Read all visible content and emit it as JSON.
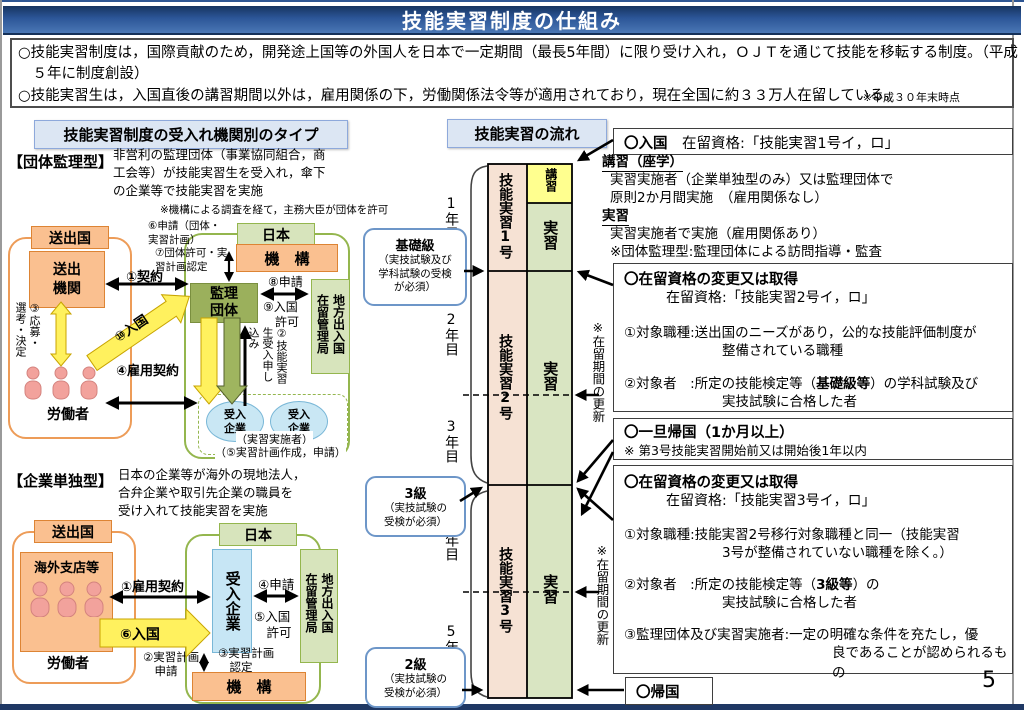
{
  "page": {
    "title": "技能実習制度の仕組み",
    "number": "5"
  },
  "overview": {
    "b1": "○技能実習制度は，国際貢献のため，開発途上国等の外国人を日本で一定期間（最長5年間）に限り受け入れ，ＯＪＴを通じて技能を移転する制度。（平成５年に制度創設）",
    "b2": "○技能実習生は，入国直後の講習期間以外は，雇用関係の下，労働関係法令等が適用されており，現在全国に約３３万人在留している。",
    "note": "※平成３０年末時点"
  },
  "left": {
    "header": "技能実習制度の受入れ機関別のタイプ",
    "dantai": {
      "label": "【団体監理型】",
      "desc": "非営利の監理団体（事業協同組合，商\n工会等）が技能実習生を受入れ，傘下\nの企業等で技能実習を実施",
      "note": "※機構による調査を経て，主務大臣が団体を許可",
      "sending_country": "送出国",
      "sending_org": "送出\n機関",
      "workers": "労働者",
      "step1": "①契約",
      "step3": "③応募・\n選考・決定",
      "step4": "④雇用契約",
      "step10": "⑩入国",
      "japan": "日本",
      "kiko": "機　構",
      "step6": "⑥申請（団体・\n実習計画）",
      "step7": "⑦団体許可・実\n習計画認定",
      "kanri": "監理\n団体",
      "step8": "⑧申請",
      "step9": "⑨入国\n　許可",
      "immigration": "地方出入国\n在留管理局",
      "step2": "②技能実習\n生受入申し\n込み",
      "step11": "⑪技能実習開始",
      "step12": "⑫指導・支援",
      "company": "受入\n企業",
      "jisshi_note": "（実習実施者）",
      "step5": "（⑤実習計画作成，申請）"
    },
    "kigyo": {
      "label": "【企業単独型】",
      "desc": "日本の企業等が海外の現地法人，\n合弁企業や取引先企業の職員を\n受け入れて技能実習を実施",
      "sending_country": "送出国",
      "overseas": "海外支店等",
      "workers": "労働者",
      "step1": "①雇用契約",
      "step6": "⑥入国",
      "japan": "日本",
      "company": "受入企業",
      "step4": "④申請",
      "step5": "⑤入国\n　許可",
      "immigration": "地方出入国\n在留管理局",
      "step2": "②実習計画\n　申請",
      "step3": "③実習計画\n　認定",
      "kiko": "機　構"
    }
  },
  "flow": {
    "header": "技能実習の流れ",
    "years": [
      "1年目",
      "2年目",
      "3年目",
      "4年目",
      "5年目"
    ],
    "stage1": "技能実習1号",
    "stage2": "技能実習2号",
    "stage3": "技能実習3号",
    "koshu": "講習",
    "jisshu": "実習",
    "renewal": "※在留期間の更新",
    "exam_kiso_title": "基礎級",
    "exam_kiso_sub": "（実技試験及び\n学科試験の受検\nが必須）",
    "exam_3_title": "3級",
    "exam_3_sub": "（実技試験の\n受検が必須）",
    "exam_2_title": "2級",
    "exam_2_sub": "（実技試験の\n受検が必須）"
  },
  "right": {
    "nyukoku_bold": "〇入国",
    "nyukoku_rest": "　在留資格:「技能実習1号イ，ロ」",
    "koshu_title": "講習（座学）",
    "koshu_l1": "実習実施者（企業単独型のみ）又は監理団体で",
    "koshu_l2": "原則2か月間実施　（雇用関係なし）",
    "jisshu_title": "実習",
    "jisshu_l1": "実習実施者で実施（雇用関係あり）",
    "jisshu_l2": "※団体監理型:監理団体による訪問指導・監査",
    "box2": {
      "heading": "〇在留資格の変更又は取得",
      "sub": "在留資格:「技能実習2号イ，ロ」",
      "i1a": "①対象職種:送出国のニーズがあり，公的な技能評価制度が",
      "i1b": "整備されている職種",
      "i2pre": "②対象者　:所定の技能検定等（",
      "i2bold": "基礎級等",
      "i2post": "）の学科試験及び",
      "i2b": "実技試験に合格した者"
    },
    "box3": {
      "heading": "〇一旦帰国（1か月以上）",
      "note": "※ 第3号技能実習開始前又は開始後1年以内"
    },
    "box4": {
      "heading": "〇在留資格の変更又は取得",
      "sub": "在留資格:「技能実習3号イ，ロ」",
      "i1a": "①対象職種:技能実習2号移行対象職種と同一（技能実習",
      "i1b": "3号が整備されていない職種を除く。）",
      "i2pre": "②対象者　:所定の技能検定等（",
      "i2bold": "3級等",
      "i2post": "）の",
      "i2b": "実技試験に合格した者",
      "i3a": "③監理団体及び実習実施者:一定の明確な条件を充たし，優",
      "i3b": "良であることが認められるもの"
    },
    "kikoku": "〇帰国"
  }
}
